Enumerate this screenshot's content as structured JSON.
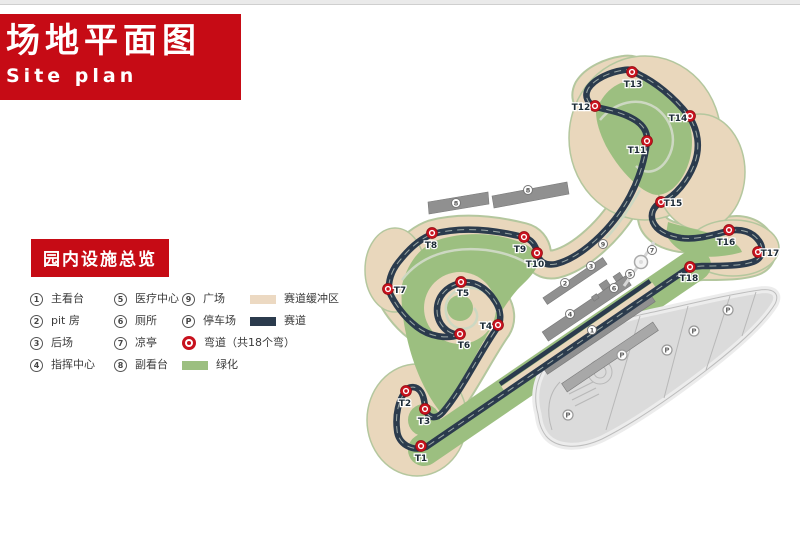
{
  "page": {
    "title_cn": "场地平面图",
    "title_en": "Site plan",
    "section_title": "园内设施总览"
  },
  "colors": {
    "brand_red": "#c60b15",
    "buffer_tan": "#e9d7bc",
    "track_dark": "#2b3b4d",
    "green": "#9cbf80",
    "corner_red": "#c8121e",
    "turn_label": "#1c2b36"
  },
  "legend": {
    "facilities": [
      {
        "num": "1",
        "label": "主看台"
      },
      {
        "num": "2",
        "label": "pit 房"
      },
      {
        "num": "3",
        "label": "后场"
      },
      {
        "num": "4",
        "label": "指挥中心"
      },
      {
        "num": "5",
        "label": "医疗中心"
      },
      {
        "num": "6",
        "label": "厕所"
      },
      {
        "num": "7",
        "label": "凉亭"
      },
      {
        "num": "8",
        "label": "副看台"
      },
      {
        "num": "9",
        "label": "广场"
      },
      {
        "num": "P",
        "label": "停车场"
      }
    ],
    "symbols": {
      "buffer": {
        "label": "赛道缓冲区",
        "color": "#ecd9c2"
      },
      "track": {
        "label": "赛道",
        "color": "#2b3b4d"
      },
      "corner": {
        "label": "弯道（共18个弯）",
        "color": "#c8121e"
      },
      "green": {
        "label": "绿化",
        "color": "#9cbf80"
      }
    }
  },
  "map": {
    "turns": [
      {
        "id": "T1",
        "x": 421,
        "y": 446,
        "lx": 421,
        "ly": 461
      },
      {
        "id": "T2",
        "x": 406,
        "y": 391,
        "lx": 405,
        "ly": 406
      },
      {
        "id": "T3",
        "x": 425,
        "y": 409,
        "lx": 424,
        "ly": 424
      },
      {
        "id": "T4",
        "x": 498,
        "y": 325,
        "lx": 486,
        "ly": 329
      },
      {
        "id": "T5",
        "x": 461,
        "y": 282,
        "lx": 463,
        "ly": 296
      },
      {
        "id": "T6",
        "x": 460,
        "y": 334,
        "lx": 464,
        "ly": 348
      },
      {
        "id": "T7",
        "x": 388,
        "y": 289,
        "lx": 400,
        "ly": 293
      },
      {
        "id": "T8",
        "x": 432,
        "y": 233,
        "lx": 431,
        "ly": 248
      },
      {
        "id": "T9",
        "x": 524,
        "y": 237,
        "lx": 520,
        "ly": 252
      },
      {
        "id": "T10",
        "x": 537,
        "y": 253,
        "lx": 535,
        "ly": 267
      },
      {
        "id": "T11",
        "x": 647,
        "y": 141,
        "lx": 637,
        "ly": 153
      },
      {
        "id": "T12",
        "x": 595,
        "y": 106,
        "lx": 581,
        "ly": 110
      },
      {
        "id": "T13",
        "x": 632,
        "y": 72,
        "lx": 633,
        "ly": 87
      },
      {
        "id": "T14",
        "x": 690,
        "y": 116,
        "lx": 678,
        "ly": 121
      },
      {
        "id": "T15",
        "x": 661,
        "y": 202,
        "lx": 673,
        "ly": 206
      },
      {
        "id": "T16",
        "x": 729,
        "y": 230,
        "lx": 726,
        "ly": 245
      },
      {
        "id": "T17",
        "x": 758,
        "y": 252,
        "lx": 770,
        "ly": 256
      },
      {
        "id": "T18",
        "x": 690,
        "y": 267,
        "lx": 689,
        "ly": 281
      }
    ],
    "facility_markers": [
      {
        "n": "8",
        "x": 456,
        "y": 203
      },
      {
        "n": "8",
        "x": 528,
        "y": 190
      },
      {
        "n": "9",
        "x": 603,
        "y": 244
      },
      {
        "n": "3",
        "x": 591,
        "y": 266
      },
      {
        "n": "5",
        "x": 630,
        "y": 274
      },
      {
        "n": "6",
        "x": 614,
        "y": 288
      },
      {
        "n": "2",
        "x": 565,
        "y": 283
      },
      {
        "n": "4",
        "x": 570,
        "y": 314
      },
      {
        "n": "1",
        "x": 592,
        "y": 330
      },
      {
        "n": "7",
        "x": 652,
        "y": 250
      }
    ],
    "parking_markers": [
      {
        "x": 568,
        "y": 415
      },
      {
        "x": 622,
        "y": 355
      },
      {
        "x": 667,
        "y": 350
      },
      {
        "x": 694,
        "y": 331
      },
      {
        "x": 728,
        "y": 310
      }
    ],
    "parking_letter": "P"
  }
}
